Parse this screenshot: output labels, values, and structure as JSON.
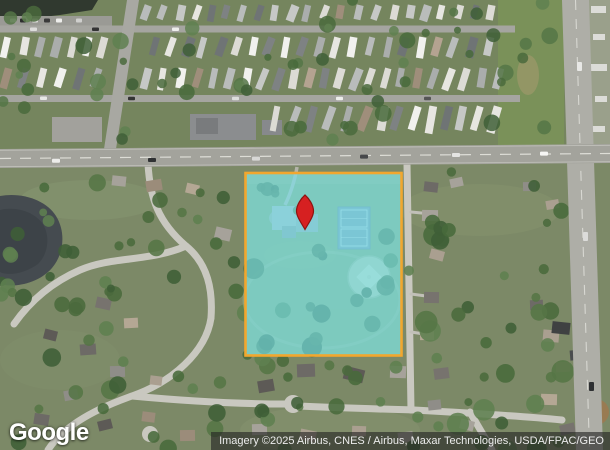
{
  "map": {
    "view_label": "satellite-imagery",
    "parcel": {
      "overlay_fill": "rgba(120,228,240,0.62)",
      "border_color": "#F2A72E"
    },
    "marker": {
      "fill": "#D62021",
      "outline": "#8F1310"
    }
  },
  "footer": {
    "logo_text": "Google",
    "attribution_text": "Imagery ©2025 Airbus, CNES / Airbus, Maxar Technologies, USDA/FPAC/GEO"
  }
}
